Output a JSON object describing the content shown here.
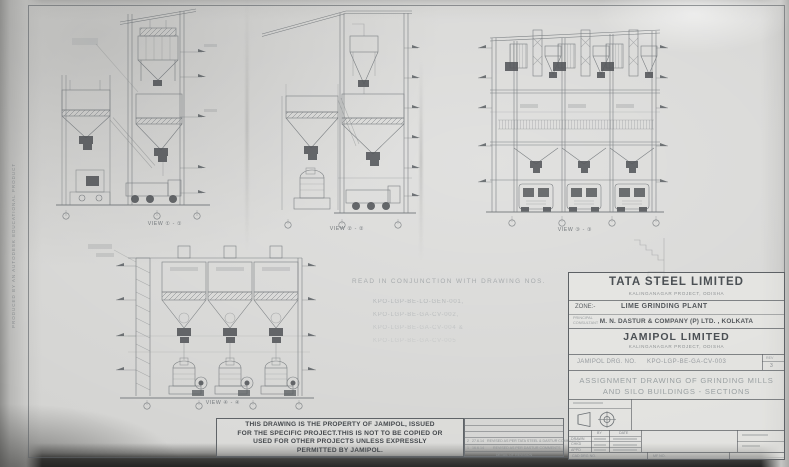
{
  "watermark": "PRODUCED BY AN AUTODESK EDUCATIONAL PRODUCT",
  "views": {
    "v1": "VIEW ① - ①",
    "v2": "VIEW ② - ②",
    "v3": "VIEW ③ - ③",
    "v4": "VIEW ④ - ④"
  },
  "note": {
    "heading": "READ IN CONJUNCTION WITH DRAWING NOS.",
    "d1": "KPO-LGP-BE-LO-GEN-001,",
    "d2": "KPO-LGP-BE-GA-CV-002,",
    "d3": "KPO-LGP-BE-GA-CV-004 &",
    "d4": "KPO-LGP-BE-GA-CV-005"
  },
  "disclaimer": {
    "l1": "THIS DRAWING IS THE PROPERTY OF JAMIPOL, ISSUED",
    "l2": "FOR THE SPECIFIC PROJECT.THIS IS NOT TO BE COPIED OR",
    "l3": "USED FOR OTHER PROJECTS UNLESS EXPRESSLY",
    "l4": "PERMITTED BY JAMIPOL."
  },
  "revisions": {
    "rows": [
      {
        "rev": "2",
        "date": "27.6.14",
        "desc": "REVISED AS PER TATA STEEL & DASTUR COMMENTS"
      },
      {
        "rev": "1",
        "date": "16.6.14",
        "desc": "REVISED AS PER DASTUR COMMENTS"
      }
    ],
    "footer": "DETAIL OF REVISION"
  },
  "title_block": {
    "company": "TATA STEEL LIMITED",
    "company_sub": "KALINGANAGAR PROJECT, ODISHA",
    "zone_label": "ZONE:-",
    "zone_value": "LIME GRINDING PLANT",
    "consultant_label_1": "PRINCIPAL",
    "consultant_label_2": "CONSULTANT",
    "consultant": "M. N. DASTUR & COMPANY (P) LTD. , KOLKATA",
    "owner": "JAMIPOL LIMITED",
    "owner_sub": "KALINGANAGAR PROJECT, ODISHA",
    "drg_label": "JAMIPOL DRG. NO.",
    "drg_no": "KPO-LGP-BE-GA-CV-003",
    "rev_label": "REV",
    "rev_value": "3",
    "title_1": "ASSIGNMENT DRAWING OF GRINDING MILLS",
    "title_2": "AND SILO BUILDINGS  -  SECTIONS",
    "sign": {
      "col_by": "BY",
      "col_date": "DATE",
      "r1": "DRAWN",
      "r2": "CHKD",
      "r3": "APPD"
    },
    "cad_label": "CAD DRG NO.",
    "mf_label": "MF NO."
  }
}
